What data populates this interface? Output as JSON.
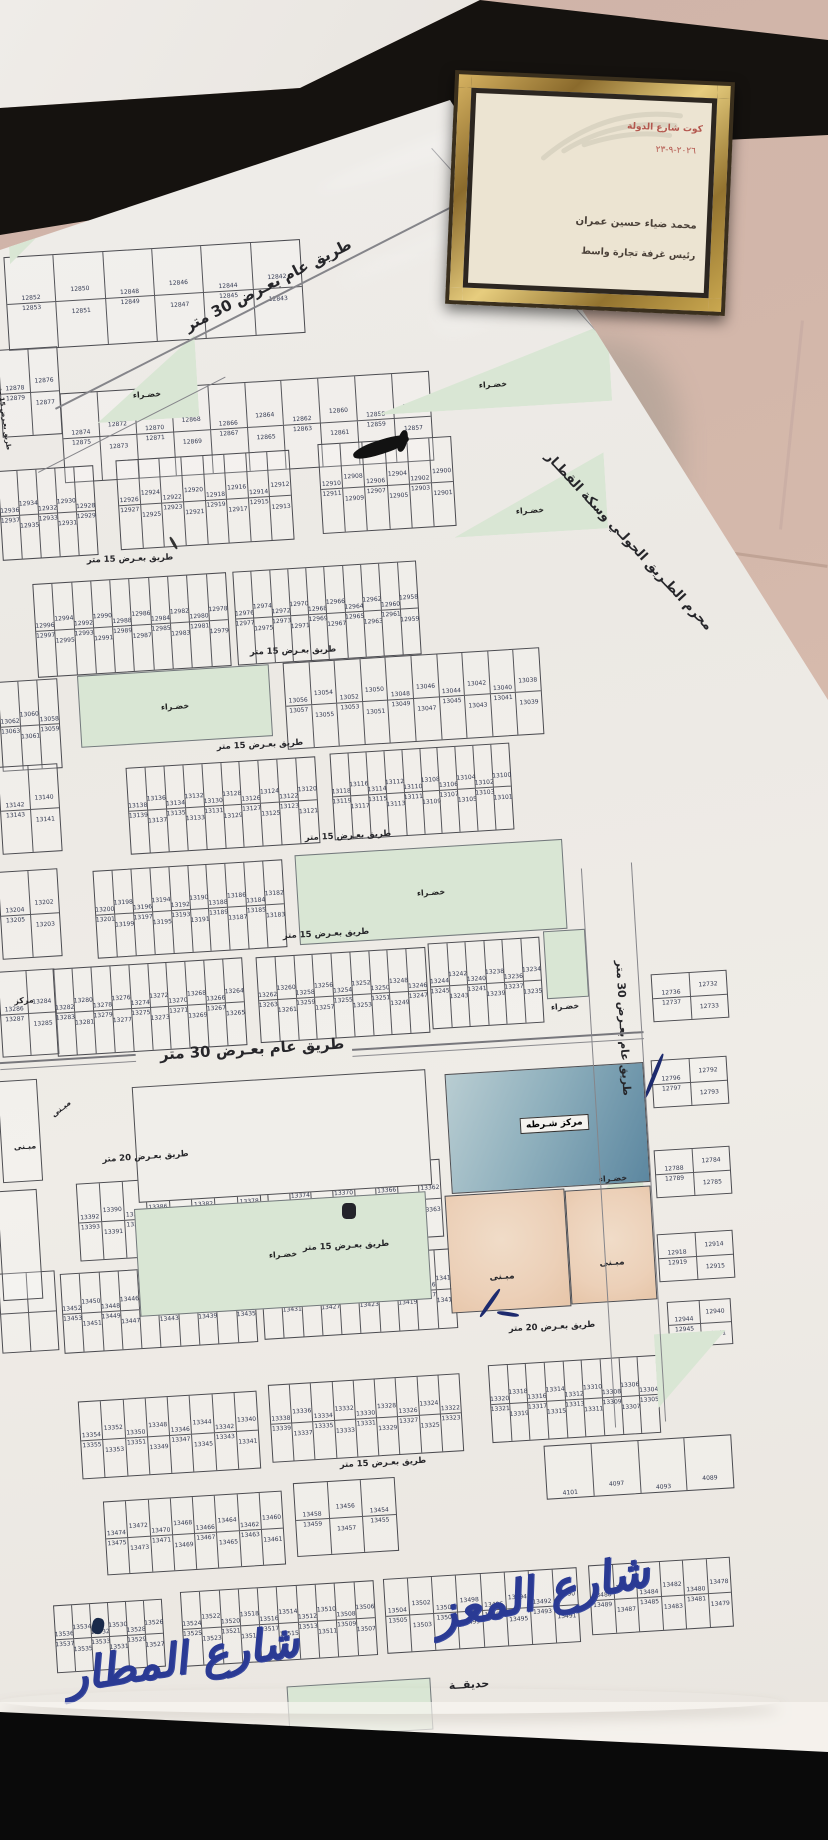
{
  "labels": {
    "road30": "طريق عام بعـرض 30 متر",
    "road15": "طريق بعـرض 15 متر",
    "road20": "طريق بعـرض 20 متر",
    "railway": "محرم الطـريق الحولـي وسكة القطـار",
    "green": "خضـراء",
    "police": "مركز شـرطه",
    "building": "مبـنى",
    "center": "مركز",
    "garden": "حديقــة"
  },
  "handwriting": {
    "street_center": "شارع المعز",
    "street_left": "شارع المطار"
  },
  "certificate": {
    "city_line": "كوت شارع الدولة",
    "date": "٢٠٢٦-٩-٢٣",
    "name": "محمد ضياء حسين عمران",
    "title": "رئيس غرفة تجارة واسط"
  },
  "colors": {
    "paper": "#eceae6",
    "green_area": "#d9e6d4",
    "police_blue": "#5c87a0",
    "building_peach": "#ecd0b8",
    "handwriting_blue": "#2a3a94",
    "frame_gold": "#caa850"
  },
  "blocks": [
    {
      "id": "r1",
      "top": [
        "12852",
        "12850",
        "12848",
        "12846",
        "12844",
        "12842"
      ],
      "bottom": [
        "12853",
        "12851",
        "12849",
        "12847",
        "12845",
        "12843"
      ]
    },
    {
      "id": "r2L",
      "top": [
        "12878",
        "12876"
      ],
      "bottom": [
        "12879",
        "12877"
      ]
    },
    {
      "id": "r2",
      "top": [
        "12874",
        "12872",
        "12870",
        "12868",
        "12866",
        "12864",
        "12862",
        "12860",
        "12858",
        "12856"
      ],
      "bottom": [
        "12875",
        "12873",
        "12871",
        "12869",
        "12867",
        "12865",
        "12863",
        "12861",
        "12859",
        "12857"
      ]
    },
    {
      "id": "r3a",
      "top": [
        "12936",
        "12934",
        "12932",
        "12930",
        "12928"
      ],
      "bottom": [
        "12937",
        "12935",
        "12933",
        "12931",
        "12929"
      ]
    },
    {
      "id": "r3b",
      "top": [
        "12926",
        "12924",
        "12922",
        "12920",
        "12918",
        "12916",
        "12914",
        "12912"
      ],
      "bottom": [
        "12927",
        "12925",
        "12923",
        "12921",
        "12919",
        "12917",
        "12915",
        "12913"
      ]
    },
    {
      "id": "r3c",
      "top": [
        "12910",
        "12908",
        "12906",
        "12904",
        "12902",
        "12900"
      ],
      "bottom": [
        "12911",
        "12909",
        "12907",
        "12905",
        "12903",
        "12901"
      ]
    },
    {
      "id": "r4a",
      "top": [
        "12996",
        "12994",
        "12992",
        "12990",
        "12988",
        "12986",
        "12984",
        "12982",
        "12980",
        "12978"
      ],
      "bottom": [
        "12997",
        "12995",
        "12993",
        "12991",
        "12989",
        "12987",
        "12985",
        "12983",
        "12981",
        "12979"
      ]
    },
    {
      "id": "r4b",
      "top": [
        "12976",
        "12974",
        "12972",
        "12970",
        "12968",
        "12966",
        "12964",
        "12962",
        "12960",
        "12958"
      ],
      "bottom": [
        "12977",
        "12975",
        "12973",
        "12971",
        "12969",
        "12967",
        "12965",
        "12963",
        "12961",
        "12959"
      ]
    },
    {
      "id": "r5L",
      "top": [
        "13062",
        "13060",
        "13058"
      ],
      "bottom": [
        "13063",
        "13061",
        "13059"
      ]
    },
    {
      "id": "r5R",
      "top": [
        "13056",
        "13054",
        "13052",
        "13050",
        "13048",
        "13046",
        "13044",
        "13042",
        "13040",
        "13038"
      ],
      "bottom": [
        "13057",
        "13055",
        "13053",
        "13051",
        "13049",
        "13047",
        "13045",
        "13043",
        "13041",
        "13039"
      ]
    },
    {
      "id": "r6L",
      "top": [
        "13142",
        "13140"
      ],
      "bottom": [
        "13143",
        "13141"
      ]
    },
    {
      "id": "r6a",
      "top": [
        "13138",
        "13136",
        "13134",
        "13132",
        "13130",
        "13128",
        "13126",
        "13124",
        "13122",
        "13120"
      ],
      "bottom": [
        "13139",
        "13137",
        "13135",
        "13133",
        "13131",
        "13129",
        "13127",
        "13125",
        "13123",
        "13121"
      ]
    },
    {
      "id": "r6b",
      "top": [
        "13118",
        "13116",
        "13114",
        "13112",
        "13110",
        "13108",
        "13106",
        "13104",
        "13102",
        "13100"
      ],
      "bottom": [
        "13119",
        "13117",
        "13115",
        "13113",
        "13111",
        "13109",
        "13107",
        "13105",
        "13103",
        "13101"
      ]
    },
    {
      "id": "r7L",
      "top": [
        "13204",
        "13202"
      ],
      "bottom": [
        "13205",
        "13203"
      ]
    },
    {
      "id": "r7a",
      "top": [
        "13200",
        "13198",
        "13196",
        "13194",
        "13192",
        "13190",
        "13188",
        "13186",
        "13184",
        "13182"
      ],
      "bottom": [
        "13201",
        "13199",
        "13197",
        "13195",
        "13193",
        "13191",
        "13189",
        "13187",
        "13185",
        "13183"
      ]
    },
    {
      "id": "r8L",
      "top": [
        "13286",
        "13284"
      ],
      "bottom": [
        "13287",
        "13285"
      ]
    },
    {
      "id": "r8b",
      "top": [
        "13282",
        "13280",
        "13278",
        "13276",
        "13274",
        "13272",
        "13270",
        "13268",
        "13266",
        "13264"
      ],
      "bottom": [
        "13283",
        "13281",
        "13279",
        "13277",
        "13275",
        "13273",
        "13271",
        "13269",
        "13267",
        "13265"
      ]
    },
    {
      "id": "r8c",
      "top": [
        "13262",
        "13260",
        "13258",
        "13256",
        "13254",
        "13252",
        "13250",
        "13248",
        "13246"
      ],
      "bottom": [
        "13263",
        "13261",
        "13259",
        "13257",
        "13255",
        "13253",
        "13251",
        "13249",
        "13247"
      ]
    },
    {
      "id": "r8d",
      "top": [
        "13244",
        "13242",
        "13240",
        "13238",
        "13236",
        "13234"
      ],
      "bottom": [
        "13245",
        "13243",
        "13241",
        "13239",
        "13237",
        "13235"
      ]
    },
    {
      "id": "r9a",
      "top": [
        "13392",
        "13390",
        "13388",
        "13386",
        "13384",
        "13382",
        "13380",
        "13378"
      ],
      "bottom": [
        "13393",
        "13391",
        "13389",
        "13387",
        "13385",
        "13383",
        "13381",
        "13379"
      ]
    },
    {
      "id": "r9b",
      "top": [
        "13376",
        "13374",
        "13372",
        "13370",
        "13368",
        "13366",
        "13364",
        "13362"
      ],
      "bottom": [
        "13377",
        "13375",
        "13373",
        "13371",
        "13369",
        "13367",
        "13365",
        "13363"
      ]
    },
    {
      "id": "r10L",
      "top": [
        "",
        ""
      ],
      "bottom": [
        "",
        ""
      ]
    },
    {
      "id": "r10a",
      "top": [
        "13452",
        "13450",
        "13448",
        "13446",
        "13444",
        "13442",
        "13440",
        "13438",
        "13436",
        "13434"
      ],
      "bottom": [
        "13453",
        "13451",
        "13449",
        "13447",
        "13445",
        "13443",
        "13441",
        "13439",
        "13437",
        "13435"
      ]
    },
    {
      "id": "r10b",
      "top": [
        "13432",
        "13430",
        "13428",
        "13426",
        "13424",
        "13422",
        "13420",
        "13418",
        "13416",
        "13414"
      ],
      "bottom": [
        "13433",
        "13431",
        "13429",
        "13427",
        "13425",
        "13423",
        "13421",
        "13419",
        "13417",
        "13415"
      ]
    },
    {
      "id": "b3a",
      "top": [
        "13354",
        "13352",
        "13350",
        "13348",
        "13346",
        "13344",
        "13342",
        "13340"
      ],
      "bottom": [
        "13355",
        "13353",
        "13351",
        "13349",
        "13347",
        "13345",
        "13343",
        "13341"
      ]
    },
    {
      "id": "b3b",
      "top": [
        "13338",
        "13336",
        "13334",
        "13332",
        "13330",
        "13328",
        "13326",
        "13324",
        "13322"
      ],
      "bottom": [
        "13339",
        "13337",
        "13335",
        "13333",
        "13331",
        "13329",
        "13327",
        "13325",
        "13323"
      ]
    },
    {
      "id": "b3c",
      "top": [
        "13320",
        "13318",
        "13316",
        "13314",
        "13312",
        "13310",
        "13308",
        "13306",
        "13304"
      ],
      "bottom": [
        "13321",
        "13319",
        "13317",
        "13315",
        "13313",
        "13311",
        "13309",
        "13307",
        "13305"
      ]
    },
    {
      "id": "b35a",
      "top": [
        "13474",
        "13472",
        "13470",
        "13468",
        "13466",
        "13464",
        "13462",
        "13460"
      ],
      "bottom": [
        "13475",
        "13473",
        "13471",
        "13469",
        "13467",
        "13465",
        "13463",
        "13461"
      ]
    },
    {
      "id": "b35b",
      "top": [
        "13458",
        "13456",
        "13454"
      ],
      "bottom": [
        "13459",
        "13457",
        "13455"
      ]
    },
    {
      "id": "r12L",
      "top": [
        "13536",
        "13534",
        "13532",
        "13530",
        "13528",
        "13526"
      ],
      "bottom": [
        "13537",
        "13535",
        "13533",
        "13531",
        "13529",
        "13527"
      ]
    },
    {
      "id": "r12a",
      "top": [
        "13524",
        "13522",
        "13520",
        "13518",
        "13516",
        "13514",
        "13512",
        "13510",
        "13508",
        "13506"
      ],
      "bottom": [
        "13525",
        "13523",
        "13521",
        "13519",
        "13517",
        "13515",
        "13513",
        "13511",
        "13509",
        "13507"
      ]
    },
    {
      "id": "r12b",
      "top": [
        "13504",
        "13502",
        "13500",
        "13498",
        "13496",
        "13494",
        "13492",
        "13490"
      ],
      "bottom": [
        "13505",
        "13503",
        "13501",
        "13499",
        "13497",
        "13495",
        "13493",
        "13491"
      ]
    },
    {
      "id": "r12c",
      "top": [
        "13488",
        "13486",
        "13484",
        "13482",
        "13480",
        "13478"
      ],
      "bottom": [
        "13489",
        "13487",
        "13485",
        "13483",
        "13481",
        "13479"
      ]
    },
    {
      "id": "m1",
      "top": [
        "12736",
        "12732"
      ],
      "bottom": [
        "12737",
        "12733"
      ]
    },
    {
      "id": "m2",
      "top": [
        "12796",
        "12792"
      ],
      "bottom": [
        "12797",
        "12793"
      ]
    },
    {
      "id": "m3",
      "top": [
        "12788",
        "12784"
      ],
      "bottom": [
        "12789",
        "12785"
      ]
    },
    {
      "id": "m4",
      "top": [
        "12918",
        "12914"
      ],
      "bottom": [
        "12919",
        "12915"
      ]
    },
    {
      "id": "m5",
      "top": [
        "12944",
        "12940"
      ],
      "bottom": [
        "12945",
        "12941"
      ]
    },
    {
      "id": "m6",
      "top": [
        "4101",
        "4097",
        "4093",
        "4089"
      ],
      "bottom": []
    }
  ]
}
